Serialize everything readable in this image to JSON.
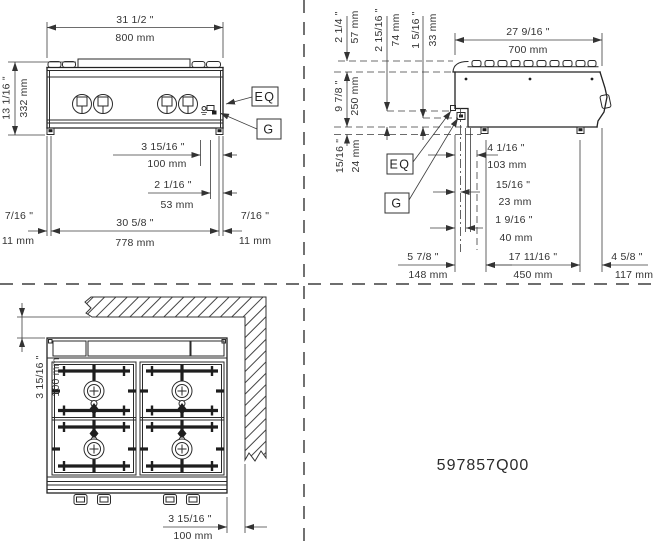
{
  "sheet": {
    "part_number": "597857Q00"
  },
  "callouts": {
    "eq": "EQ",
    "g": "G"
  },
  "front": {
    "width_in": "31 1/2 \"",
    "width_mm": "800 mm",
    "height_in": "13 1/16 \"",
    "height_mm": "332 mm",
    "off100_in": "3 15/16 \"",
    "off100_mm": "100 mm",
    "off53_in": "2 1/16 \"",
    "off53_mm": "53 mm",
    "inset_left_in": "7/16 \"",
    "inset_left_mm": "11 mm",
    "span_in": "30 5/8 \"",
    "span_mm": "778 mm",
    "inset_right_in": "7/16 \"",
    "inset_right_mm": "11 mm"
  },
  "side": {
    "depth_in": "27 9/16 \"",
    "depth_mm": "700 mm",
    "grate_h_in": "2 1/4 \"",
    "grate_h_mm": "57 mm",
    "eq_h_in": "2 15/16 \"",
    "eq_h_mm": "74 mm",
    "gas_h_in": "1 5/16 \"",
    "gas_h_mm": "33 mm",
    "body_h_in": "9 7/8 \"",
    "body_h_mm": "250 mm",
    "foot_h_in": "15/16 \"",
    "foot_h_mm": "24 mm",
    "off103_in": "4 1/16 \"",
    "off103_mm": "103 mm",
    "off23_in": "15/16 \"",
    "off23_mm": "23 mm",
    "off40_in": "1 9/16 \"",
    "off40_mm": "40 mm",
    "off148_in": "5 7/8 \"",
    "off148_mm": "148 mm",
    "off450_in": "17 11/16 \"",
    "off450_mm": "450 mm",
    "off117_in": "4 5/8 \"",
    "off117_mm": "117 mm"
  },
  "plan": {
    "clear_left_in": "3 15/16 \"",
    "clear_left_mm": "100 mm",
    "clear_right_in": "3 15/16 \"",
    "clear_right_mm": "100 mm"
  }
}
